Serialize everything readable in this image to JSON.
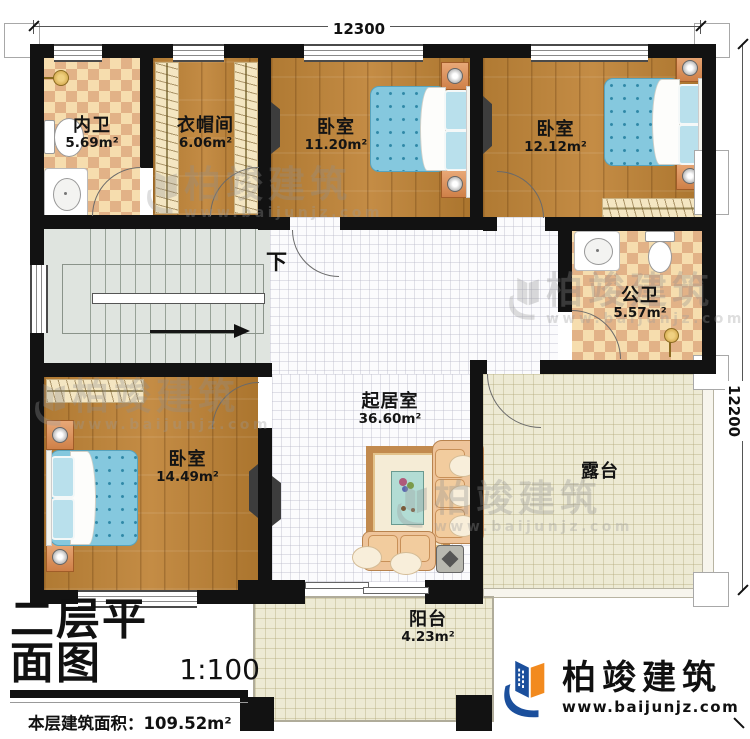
{
  "dimensions": {
    "top": "12300",
    "right": "12200"
  },
  "rooms": {
    "inner_bath": {
      "name": "内卫",
      "area": "5.69m²"
    },
    "cloakroom": {
      "name": "衣帽间",
      "area": "6.06m²"
    },
    "bedroom_top": {
      "name": "卧室",
      "area": "11.20m²"
    },
    "bedroom_right": {
      "name": "卧室",
      "area": "12.12m²"
    },
    "public_bath": {
      "name": "公卫",
      "area": "5.57m²"
    },
    "living_room": {
      "name": "起居室",
      "area": "36.60m²"
    },
    "bedroom_left": {
      "name": "卧室",
      "area": "14.49m²"
    },
    "terrace": {
      "name": "露台"
    },
    "balcony": {
      "name": "阳台",
      "area": "4.23m²"
    }
  },
  "stairs": {
    "down_label": "下"
  },
  "title_block": {
    "title": "二层平面图",
    "scale": "1:100",
    "floor_area": "本层建筑面积：109.52m²",
    "floor_height": "层高：3.6m"
  },
  "branding": {
    "name": "柏竣建筑",
    "website": "www.baijunjz.com"
  },
  "colors": {
    "wall": "#121212",
    "wood_floor": "#b6813b",
    "tile_light": "#f6ddae",
    "tile_dark": "#e2b287",
    "stair_floor": "#dfe4df",
    "terrace_floor": "#edead4",
    "bed_blue": "#85c8de",
    "brand_blue": "#1b4f9c",
    "brand_orange": "#f28a1e"
  }
}
